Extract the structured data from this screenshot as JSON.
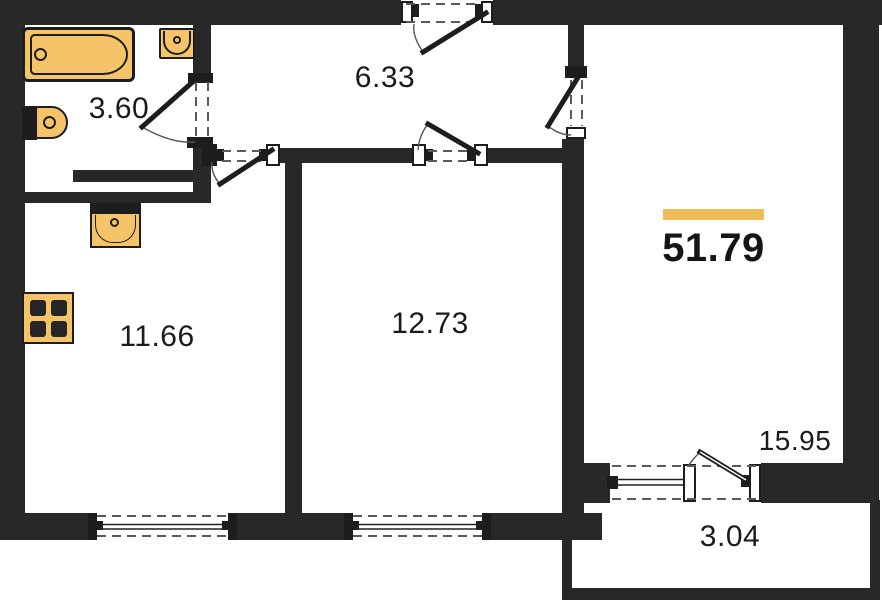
{
  "plan_title": "two-room apartment floor plan",
  "total": {
    "area": "51.79"
  },
  "rooms": {
    "bathroom": {
      "area": "3.60"
    },
    "hallway": {
      "area": "6.33"
    },
    "kitchen": {
      "area": "11.66"
    },
    "bedroom": {
      "area": "12.73"
    },
    "living_room": {
      "area": "15.95"
    },
    "balcony": {
      "area": "3.04"
    }
  },
  "fixtures": [
    "bathtub",
    "bathroom-sink",
    "toilet",
    "kitchen-sink",
    "stove"
  ],
  "colors": {
    "wall": "#282828",
    "fixture_yellow": "#F5C469",
    "highlight_bar": "#F1BD58",
    "text": "#1b1b1b"
  }
}
